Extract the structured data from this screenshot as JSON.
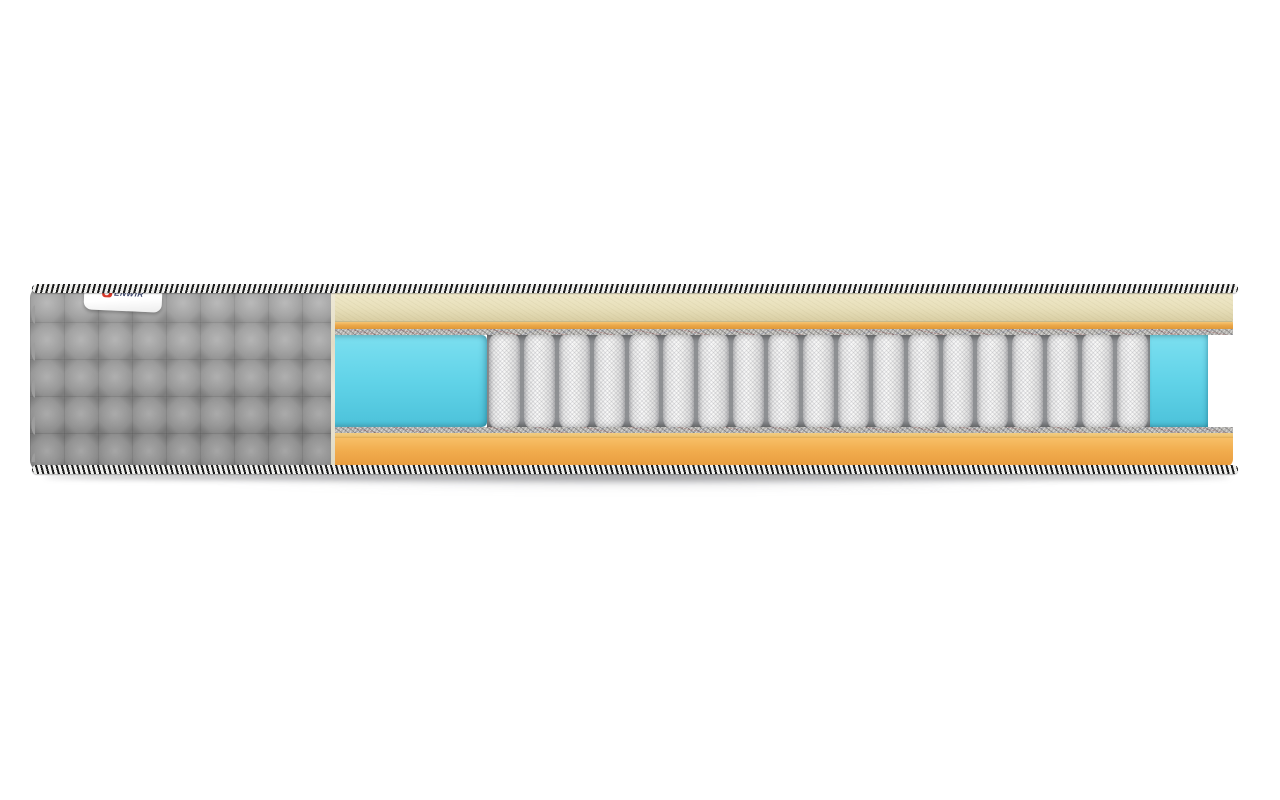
{
  "scene": {
    "description": "3D cutaway render of a pocket-spring mattress on a white background",
    "background_color": "#ffffff"
  },
  "brand_tag": {
    "text": "ENWIR",
    "logo_icon": "brand-logo-icon",
    "colors": {
      "tag": "#ffffff",
      "logo-red": "#d8382a",
      "logo-text": "#39436b"
    }
  },
  "mattress": {
    "spring_count": 19,
    "colors": {
      "quilt-gray": "#9d9d9d",
      "cream": "#e8e0bb",
      "cream-dark": "#d9cea4",
      "orange-band": "#eba94b",
      "orange-base": "#f1ac4d",
      "orange-base-dark": "#e89c3e",
      "yellow-line": "#eec372",
      "felt": "#b5b3af",
      "blue-foam": "#61d3e8",
      "blue-foam-dark": "#4cc2da",
      "spring-white": "#f9f9f9",
      "spring-shade": "#b9b9bb",
      "spring-gap": "#8e9093",
      "rope-dark": "#1b1b1b",
      "rope-light": "#f0f0ee"
    }
  }
}
